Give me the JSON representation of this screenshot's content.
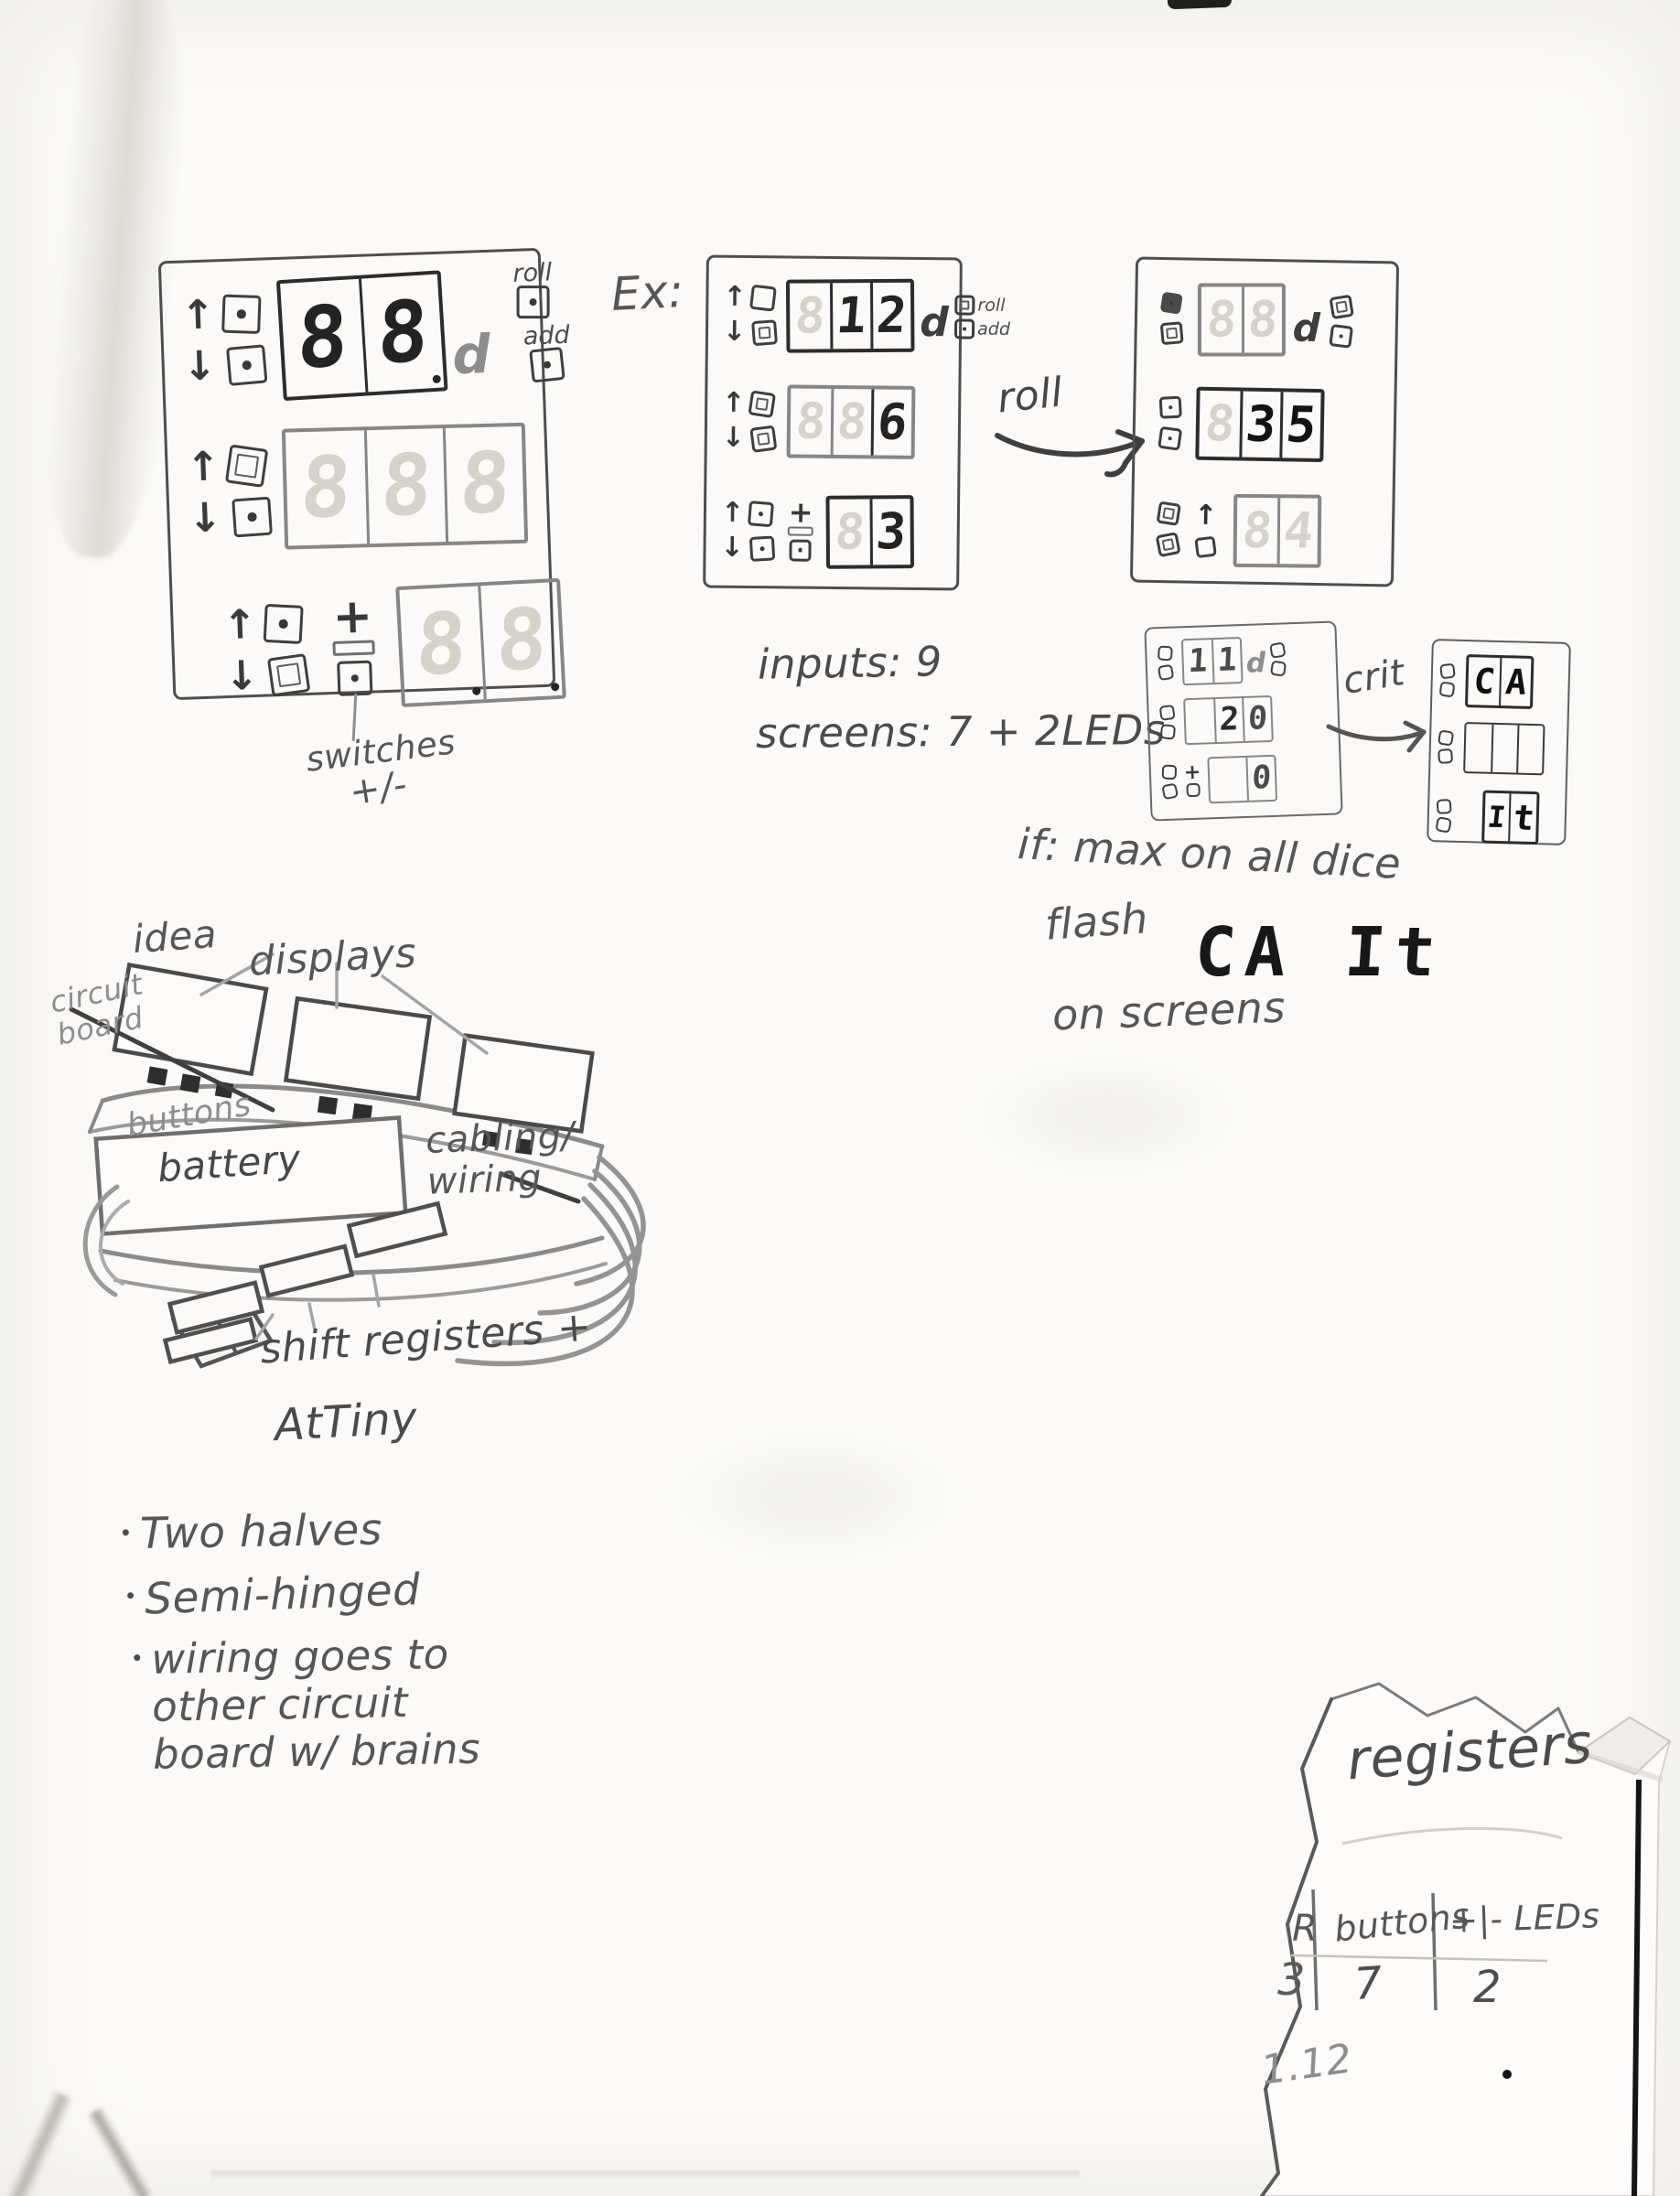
{
  "labels": {
    "ex": "Ex:",
    "roll": "roll",
    "crit": "crit",
    "inputs": "inputs: 9",
    "screens": "screens: 7 + 2LEDs",
    "if_line1": "if: max on all dice",
    "flash": "flash",
    "crit_display": "CA It",
    "on_screens": "on screens",
    "switches1": "switches",
    "switches2": "+/-"
  },
  "icons": {
    "up": "↑",
    "down": "↓",
    "plus": "+",
    "right_arrow": "→"
  },
  "panels": {
    "main": {
      "row1": {
        "digits": [
          {
            "v": "8"
          },
          {
            "v": "8"
          }
        ],
        "after": "d",
        "side": [
          {
            "label": "roll"
          },
          {
            "label": "add"
          }
        ]
      },
      "row2": {
        "digits": [
          {
            "v": "8"
          },
          {
            "v": "8"
          },
          {
            "v": "8"
          }
        ]
      },
      "row3": {
        "digits": [
          {
            "v": "8"
          },
          {
            "v": "8"
          }
        ]
      },
      "caption1": "switches",
      "caption2": "+/-"
    },
    "ex": {
      "row1": {
        "digits": [
          {
            "v": "8"
          },
          {
            "v": "1"
          },
          {
            "v": "2"
          }
        ],
        "after": "d",
        "side": [
          {
            "label": "roll"
          },
          {
            "label": "add"
          }
        ]
      },
      "row2": {
        "digits": [
          {
            "v": "8"
          },
          {
            "v": "8"
          },
          {
            "v": "6"
          }
        ]
      },
      "row3": {
        "digits": [
          {
            "v": "8"
          },
          {
            "v": "3"
          }
        ]
      }
    },
    "rolled": {
      "row1": {
        "digits": [
          {
            "v": "8"
          },
          {
            "v": "8"
          }
        ],
        "after": "d"
      },
      "row2": {
        "digits": [
          {
            "v": "8"
          },
          {
            "v": "3"
          },
          {
            "v": "5"
          }
        ]
      },
      "row3": {
        "digits": [
          {
            "v": "8"
          },
          {
            "v": "4"
          }
        ]
      }
    },
    "crit_before": {
      "row1": {
        "digits": [
          {
            "v": "1"
          },
          {
            "v": "1"
          }
        ],
        "after": "d"
      },
      "row2": {
        "digits": [
          {
            "v": ""
          },
          {
            "v": "2"
          },
          {
            "v": "0"
          }
        ]
      },
      "row3": {
        "digits": [
          {
            "v": ""
          },
          {
            "v": "0"
          }
        ]
      }
    },
    "crit_after": {
      "row1": {
        "digits": [
          {
            "v": "C"
          },
          {
            "v": "A"
          }
        ]
      },
      "row2": {
        "digits": [
          {
            "v": ""
          },
          {
            "v": ""
          },
          {
            "v": ""
          }
        ]
      },
      "row3": {
        "digits": [
          {
            "v": "I"
          },
          {
            "v": "t"
          }
        ]
      }
    }
  },
  "sketch": {
    "idea": "idea",
    "displays": "displays",
    "circuit_board": "circuit\nboard",
    "buttons": "buttons",
    "battery": "battery",
    "cabling": "cabling/\nwiring",
    "shift_registers": "shift registers +",
    "attiny": "AtTiny"
  },
  "notes": [
    "Two halves",
    "Semi-hinged",
    "wiring goes to\nother circuit\nboard w/ brains"
  ],
  "torn": {
    "heading": "registers",
    "col1_header": "R",
    "col2_header": "buttons",
    "col3_header": "+|- LEDs",
    "val1": "3",
    "val2": "7",
    "val3": "2",
    "footnote": "1.12"
  }
}
